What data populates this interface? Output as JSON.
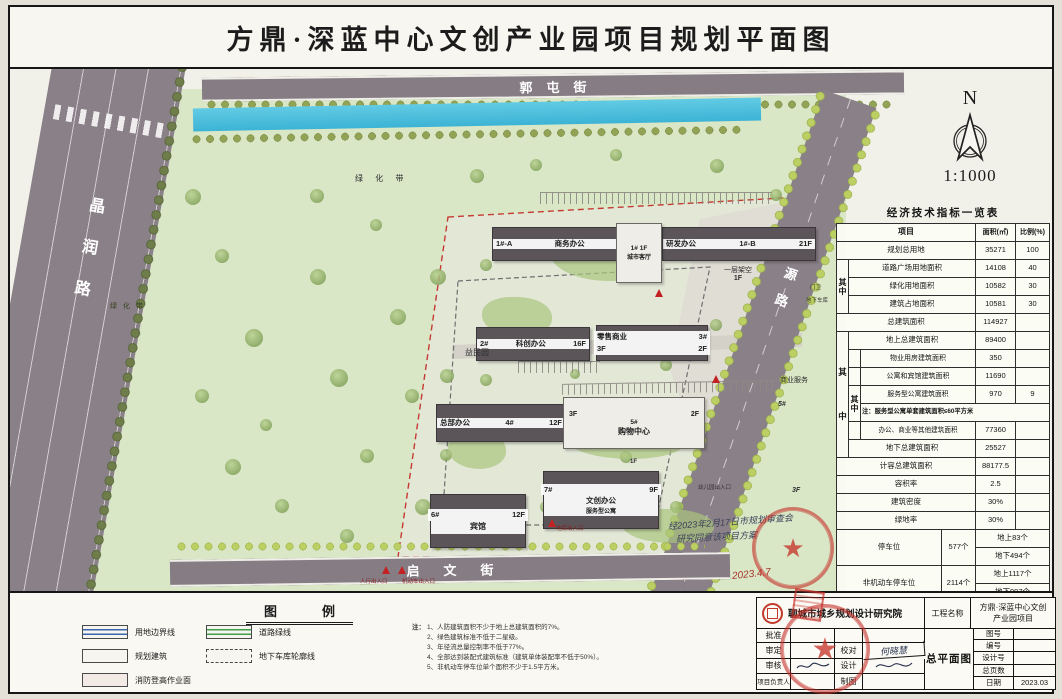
{
  "title": "方鼎·深蓝中心文创产业园项目规划平面图",
  "compass": {
    "north": "N",
    "scale": "1:1000"
  },
  "roads": {
    "top": "郭屯街",
    "left": "晶润路",
    "right": "和源路",
    "bottom": "启文街"
  },
  "map_labels": {
    "greenbelt1": "绿 化 带",
    "greenbelt2": "绿 化 带",
    "park_name": "益民园",
    "stilt": "一层架空",
    "stilt_floor": "1F",
    "biz_service": "商业服务",
    "biz_num": "5#",
    "kindergarten": "幼儿园出入口",
    "f3": "3F",
    "f1": "1F",
    "gate": "门卫",
    "garage": "地下车库",
    "ped_entrance": "人行出入口",
    "vehicle_entrance": "机动车出入口",
    "garage_entrance": "地库出入口"
  },
  "buildings": [
    {
      "id": "1#-A",
      "name": "商务办公",
      "floors": "18F"
    },
    {
      "id": "1#",
      "floors": "1F",
      "name": "城市客厅"
    },
    {
      "id": "1#-B",
      "name": "研发办公",
      "floors": "21F"
    },
    {
      "id": "2#",
      "name": "科创办公",
      "floors": "16F"
    },
    {
      "id": "3#",
      "name": "零售商业",
      "floors": "3F",
      "floors2": "2F"
    },
    {
      "id": "4#",
      "name": "总部办公",
      "floors": "12F"
    },
    {
      "id": "5#",
      "name": "购物中心",
      "floors": "3F",
      "floors2": "2F"
    },
    {
      "id": "6#",
      "name": "宾馆",
      "floors": "12F"
    },
    {
      "id": "7#",
      "name": "文创办公",
      "sub": "服务型公寓",
      "floors": "9F"
    }
  ],
  "annotation": {
    "line1": "经2023年2月17日市规划审查会",
    "line2": "研究同意该项目方案",
    "date": "2023.4.7"
  },
  "indicators": {
    "title": "经济技术指标一览表",
    "col_item": "项目",
    "col_area": "面积(㎡)",
    "col_ratio": "比例(%)",
    "qi": "其",
    "zhong": "中",
    "rows": {
      "total_land": {
        "label": "规划总用地",
        "area": "35271",
        "ratio": "100"
      },
      "road_plaza": {
        "label": "道路广场用地面积",
        "area": "14108",
        "ratio": "40"
      },
      "green_land": {
        "label": "绿化用地面积",
        "area": "10582",
        "ratio": "30"
      },
      "footprint": {
        "label": "建筑占地面积",
        "area": "10581",
        "ratio": "30"
      },
      "total_gfa": {
        "label": "总建筑面积",
        "area": "114927"
      },
      "above_gfa": {
        "label": "地上总建筑面积",
        "area": "89400"
      },
      "property": {
        "label": "物业用房建筑面积",
        "area": "350"
      },
      "apartment_hotel": {
        "label": "公寓和宾馆建筑面积",
        "area": "11690"
      },
      "service_apartment": {
        "label": "服务型公寓建筑面积",
        "area": "970",
        "ratio": "9"
      },
      "note": "注：服务型公寓单套建筑面积≤60平方米",
      "office_commercial": {
        "label": "办公、商业等其他建筑面积",
        "area": "77360"
      },
      "below_gfa": {
        "label": "地下总建筑面积",
        "area": "25527"
      },
      "countable_gfa": {
        "label": "计容总建筑面积",
        "area": "88177.5"
      },
      "far": {
        "label": "容积率",
        "area": "2.5"
      },
      "density": {
        "label": "建筑密度",
        "area": "30%"
      },
      "green_ratio": {
        "label": "绿地率",
        "area": "30%"
      },
      "parking": {
        "label": "停车位",
        "count": "577个",
        "above": "地上83个",
        "below": "地下494个"
      },
      "non_motor": {
        "label": "非机动车停车位",
        "count": "2114个",
        "above": "地上1117个",
        "below": "地下997个"
      }
    }
  },
  "legend": {
    "title": "图　例",
    "items": [
      {
        "label": "用地边界线"
      },
      {
        "label": "道路绿线"
      },
      {
        "label": "规划建筑"
      },
      {
        "label": "地下车库轮廓线"
      },
      {
        "label": "消防登高作业面"
      }
    ]
  },
  "notes": {
    "prefix": "注：",
    "items": [
      "1、人防建筑面积不少于地上总建筑面积的7%。",
      "2、绿色建筑标准不低于二星级。",
      "3、年径流总量控制率不低于77%。",
      "4、全部达到装配式建筑标准（建筑单体装配率不低于50%）。",
      "5、非机动车停车位单个面积不少于1.5平方米。"
    ]
  },
  "titleblock": {
    "institute": "聊城市城乡规划设计研究院",
    "project_label": "工程名称",
    "project_name1": "方鼎·深蓝中心文创",
    "project_name2": "产业园项目",
    "drawing_name": "总平面图",
    "left_rows": [
      {
        "label": "批准"
      },
      {
        "label": "审定"
      },
      {
        "label": "审核"
      },
      {
        "label": "项目负责人"
      }
    ],
    "mid_rows": [
      {
        "label": ""
      },
      {
        "label": "校对",
        "sig": "何晓慧"
      },
      {
        "label": "设计"
      },
      {
        "label": "制图"
      }
    ],
    "right_rows": [
      {
        "label": "图号",
        "value": ""
      },
      {
        "label": "编号",
        "value": ""
      },
      {
        "label": "设计号",
        "value": ""
      },
      {
        "label": "总页数",
        "value": ""
      },
      {
        "label": "日期",
        "value": "2023.03"
      }
    ]
  }
}
